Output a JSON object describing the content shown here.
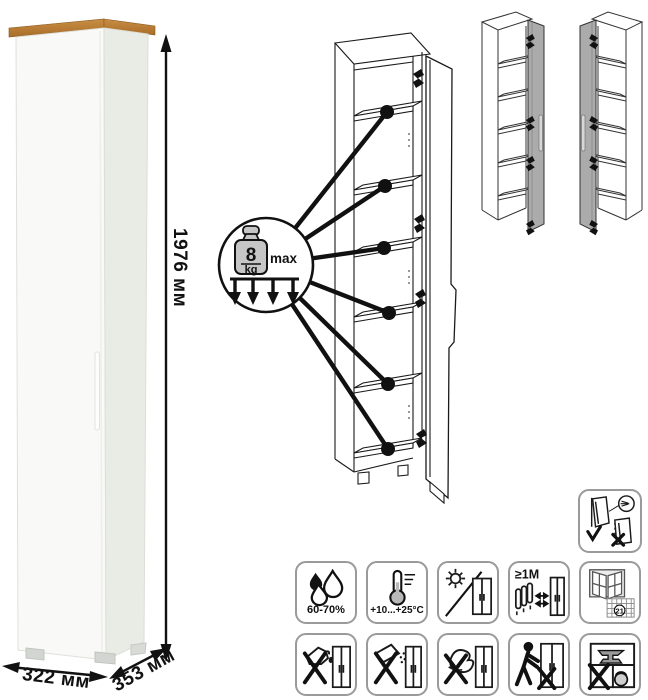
{
  "product": {
    "dimensions": {
      "height": "1976 мм",
      "width": "322 мм",
      "depth": "353 мм"
    },
    "shelf_load": {
      "value": "8",
      "unit": "kg",
      "qualifier": "max"
    },
    "shelf_count": 6
  },
  "colors": {
    "wood_top": "#b5782f",
    "body_white": "#f9f9f7",
    "side_shade": "#e9ebe5",
    "diagram_line": "#1a1a1a",
    "door_gray": "#ababab",
    "icon_border": "#9a9a9a"
  },
  "care_icons": {
    "wall_mount": {
      "name": "anchor-to-wall-required"
    },
    "row1": [
      {
        "name": "humidity-range",
        "label": "60-70%"
      },
      {
        "name": "temperature-range",
        "label": "+10...+25°C"
      },
      {
        "name": "avoid-direct-sunlight",
        "label": ""
      },
      {
        "name": "keep-distance-from-heat",
        "label": "≥1M"
      },
      {
        "name": "ventilate-room",
        "calendar_day": "21"
      }
    ],
    "row2": [
      {
        "name": "no-pouring-liquids"
      },
      {
        "name": "no-abrasive-powders"
      },
      {
        "name": "no-harsh-scrubbing"
      },
      {
        "name": "no-dragging"
      },
      {
        "name": "no-heavy-items-overload"
      }
    ]
  }
}
